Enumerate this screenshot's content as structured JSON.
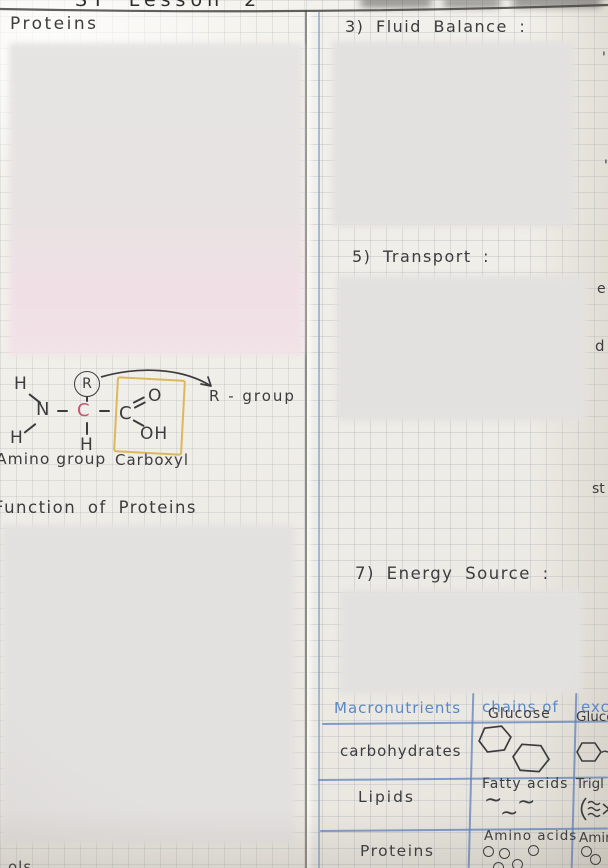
{
  "header": {
    "title_fragment": "ST  Lesson  2"
  },
  "left": {
    "title": "Proteins",
    "function_heading": "Function of Proteins",
    "bottom_fragment": "ols",
    "diagram": {
      "h_top_left": "H",
      "h_bottom_left": "H",
      "h_below": "H",
      "n": "N",
      "c_alpha": "C",
      "c_carboxyl": "C",
      "o": "O",
      "oh": "OH",
      "r": "R",
      "amino_label": "Amino group",
      "carboxyl_label": "Carboxyl",
      "r_group_label": "R - group"
    }
  },
  "right": {
    "section3": "3) Fluid Balance :",
    "section5": "5) Transport :",
    "section7": "7) Energy Source :",
    "frag_mark": "'",
    "frag_e": "e",
    "frag_d": "d",
    "frag_st": "st",
    "table": {
      "header": [
        "Macronutrients",
        "chains of",
        "exc"
      ],
      "rows": [
        {
          "name": "carbohydrates",
          "chain": "Glucose",
          "excess": "Glucos"
        },
        {
          "name": "Lipids",
          "chain": "Fatty acids",
          "excess": "Trigl"
        },
        {
          "name": "Proteins",
          "chain": "Amino acids",
          "excess": "Amin"
        }
      ],
      "squiggle": "~",
      "hex_tail": "~"
    }
  },
  "colors": {
    "ink": "#3c3c3e",
    "blue_text": "#5b87c7",
    "table_line": "#6f95c8",
    "alpha_carbon_red": "#c4566f",
    "carboxyl_box_yellow": "#dcb85c"
  }
}
